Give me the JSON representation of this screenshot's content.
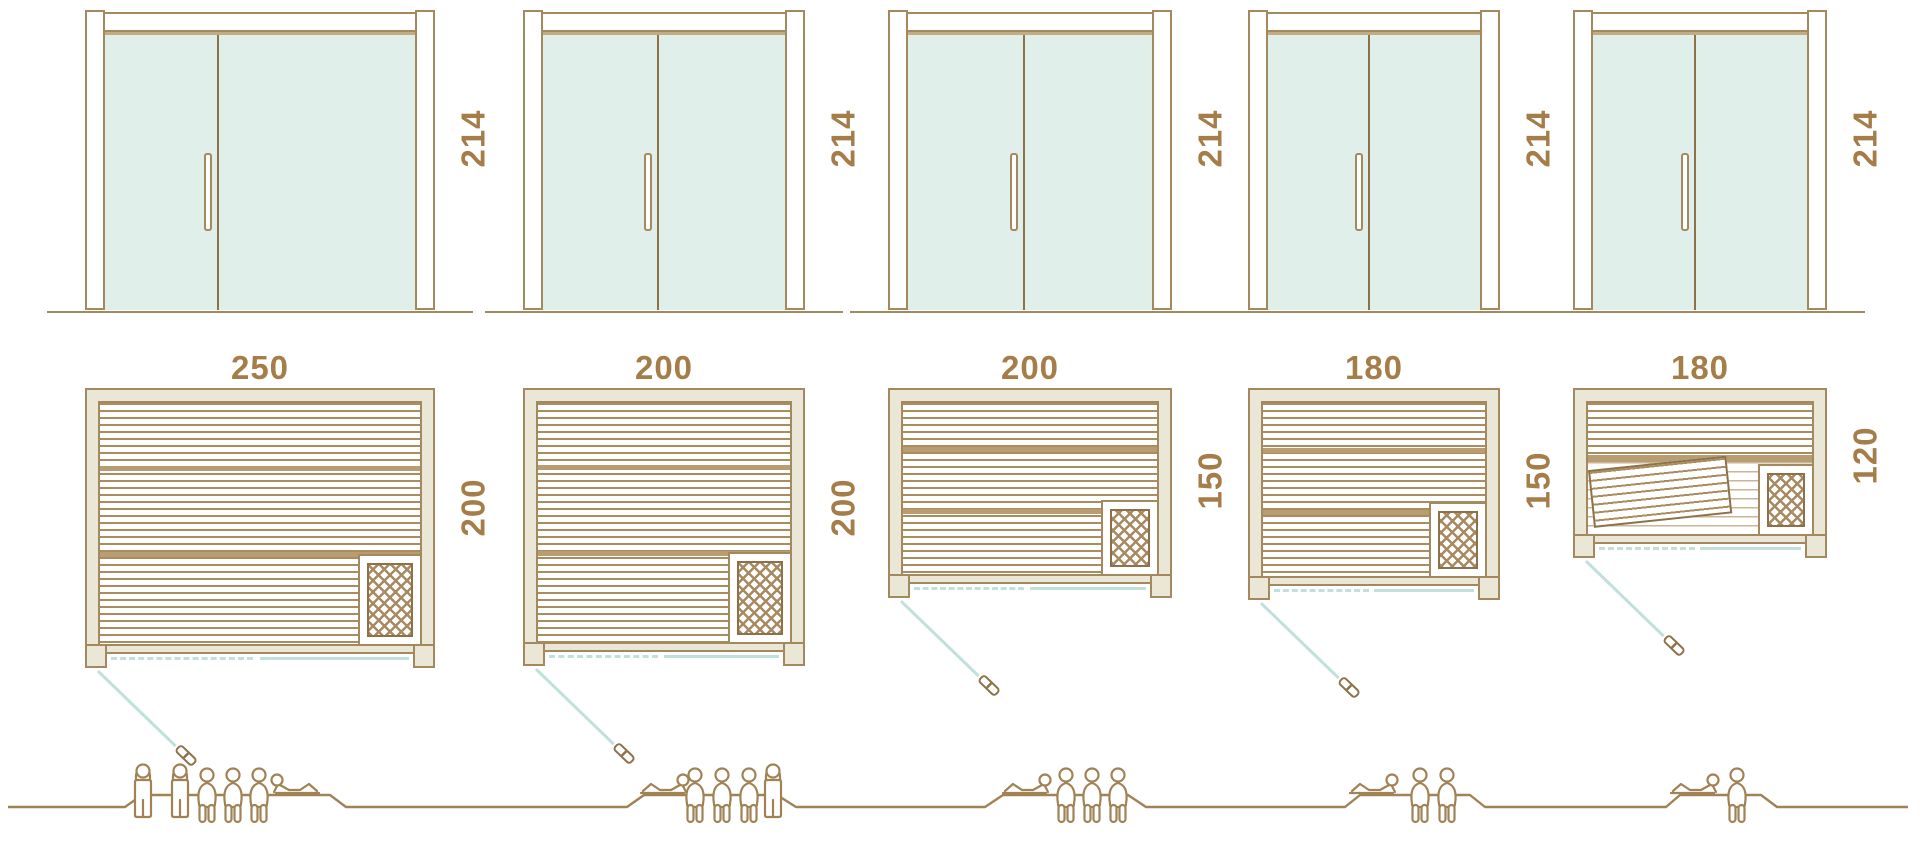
{
  "units_note": "cm",
  "colors": {
    "outline_brown": "#a5895e",
    "dark_brown": "#8d7148",
    "dimension_text": "#a57d49",
    "glass_mint": "#e1efeb",
    "wall_beige": "#eae7d6",
    "slat_brown": "#ab8c5f",
    "door_swing_teal": "#bfe0db",
    "figure_brown": "#a08255",
    "background": "#ffffff"
  },
  "icons": {
    "heater": "crosshatch-lattice square in plan corner",
    "door_open_handle": "small brown capsule at end of teal swing line",
    "person_standing": "outline figure, hands behind head",
    "person_seated": "outline figure seated, legs hanging",
    "person_reclining": "outline figure lying propped on elbow"
  },
  "saunas": [
    {
      "name": "sauna-250x200",
      "door_height": "214",
      "width": "250",
      "depth": "200",
      "capacity": 6,
      "figures": [
        "standing",
        "standing",
        "seated",
        "seated",
        "seated",
        "reclining"
      ],
      "heater_position": "bottom-right",
      "door_position": "bottom-left"
    },
    {
      "name": "sauna-200x200",
      "door_height": "214",
      "width": "200",
      "depth": "200",
      "capacity": 5,
      "figures": [
        "reclining",
        "seated",
        "seated",
        "seated",
        "standing"
      ],
      "heater_position": "bottom-right",
      "door_position": "bottom-left"
    },
    {
      "name": "sauna-200x150",
      "door_height": "214",
      "width": "200",
      "depth": "150",
      "capacity": 4,
      "figures": [
        "reclining",
        "seated",
        "seated",
        "seated"
      ],
      "heater_position": "bottom-right",
      "door_position": "bottom-left"
    },
    {
      "name": "sauna-180x150",
      "door_height": "214",
      "width": "180",
      "depth": "150",
      "capacity": 3,
      "figures": [
        "reclining",
        "seated",
        "seated"
      ],
      "heater_position": "bottom-right",
      "door_position": "bottom-left"
    },
    {
      "name": "sauna-180x120",
      "door_height": "214",
      "width": "180",
      "depth": "120",
      "capacity": 2,
      "figures": [
        "reclining",
        "seated"
      ],
      "heater_position": "bottom-right",
      "door_position": "bottom-left",
      "extra": "angled bench in lower half of plan"
    }
  ]
}
